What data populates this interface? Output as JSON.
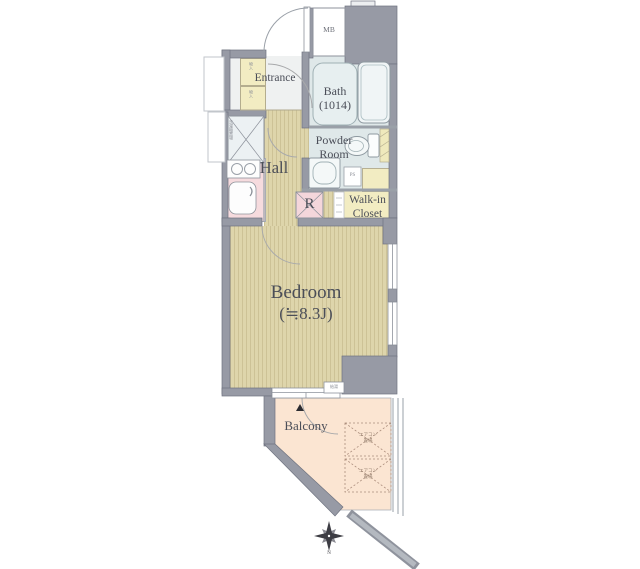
{
  "plan_title": "apartment-floor-plan",
  "rooms": {
    "entrance": {
      "label": "Entrance"
    },
    "bath": {
      "label": "Bath",
      "size": "(1014)"
    },
    "powder_room": {
      "line1": "Powder",
      "line2": "Room"
    },
    "hall": {
      "label": "Hall"
    },
    "refrigerator": {
      "label": "R"
    },
    "walk_in_closet": {
      "line1": "Walk-in",
      "line2": "Closet"
    },
    "bedroom": {
      "label": "Bedroom",
      "size": "(≒8.3J)"
    },
    "balcony": {
      "label": "Balcony"
    },
    "meter_box": {
      "label": "MB"
    },
    "pipe_space": {
      "label": "PS"
    }
  },
  "small_labels": {
    "washer": "洗濯機置場",
    "shoe_box_upper": "物入",
    "shoe_box_lower": "物入",
    "water_heater": "給湯",
    "ac_unit_1_line1": "エアコン",
    "ac_unit_1_line2": "置場",
    "ac_unit_2_line1": "エアコン",
    "ac_unit_2_line2": "置場",
    "compass_letter": "N"
  },
  "colors": {
    "wall_gray": "#979aa5",
    "wall_outline": "#6f7380",
    "floor_wood": "#ded5ab",
    "floor_bath": "#dfe8e9",
    "floor_closet_yellow": "#f2ecc2",
    "kitchen_pink": "#f6dbde",
    "balcony_peach": "#fbe5d2",
    "entrance_gray": "#eff1f1",
    "text": "#4b4e58"
  }
}
